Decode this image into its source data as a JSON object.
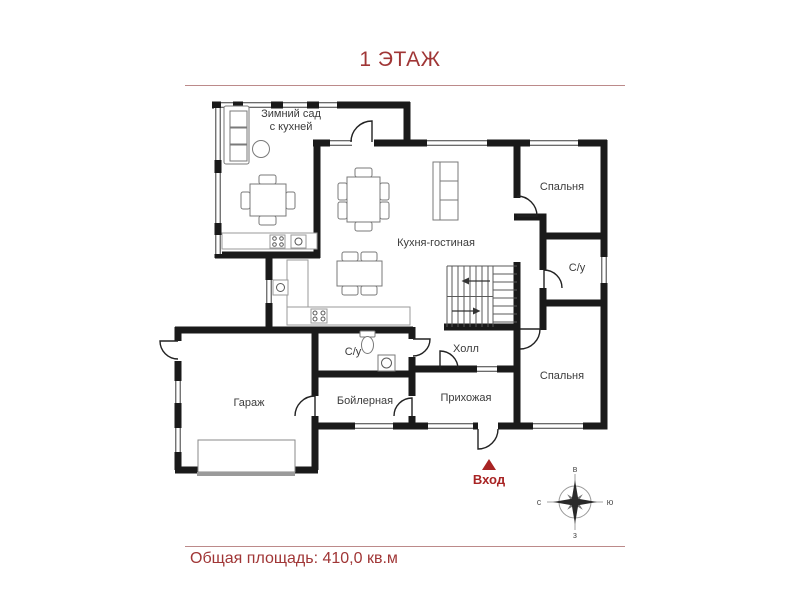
{
  "title": "1 ЭТАЖ",
  "footer": {
    "total_area": "Общая площадь: 410,0 кв.м"
  },
  "entrance": {
    "label": "Вход"
  },
  "compass": {
    "top": "в",
    "right": "ю",
    "bottom": "з",
    "left": "с"
  },
  "rooms": [
    {
      "id": "winter-garden",
      "label": "Зимний сад",
      "label2": "с кухней"
    },
    {
      "id": "kitchen-living",
      "label": "Кухня-гостиная"
    },
    {
      "id": "bedroom-1",
      "label": "Спальня"
    },
    {
      "id": "bathroom-1",
      "label": "С/у"
    },
    {
      "id": "hall",
      "label": "Холл"
    },
    {
      "id": "bedroom-2",
      "label": "Спальня"
    },
    {
      "id": "garage",
      "label": "Гараж"
    },
    {
      "id": "bathroom-2",
      "label": "С/у"
    },
    {
      "id": "boiler-room",
      "label": "Бойлерная"
    },
    {
      "id": "entry-hall",
      "label": "Прихожая"
    }
  ],
  "colors": {
    "accent_text": "#a03636",
    "rule_line": "#bc8a8a",
    "entrance_marker": "#a82424",
    "walls": "#1a1a1a"
  }
}
